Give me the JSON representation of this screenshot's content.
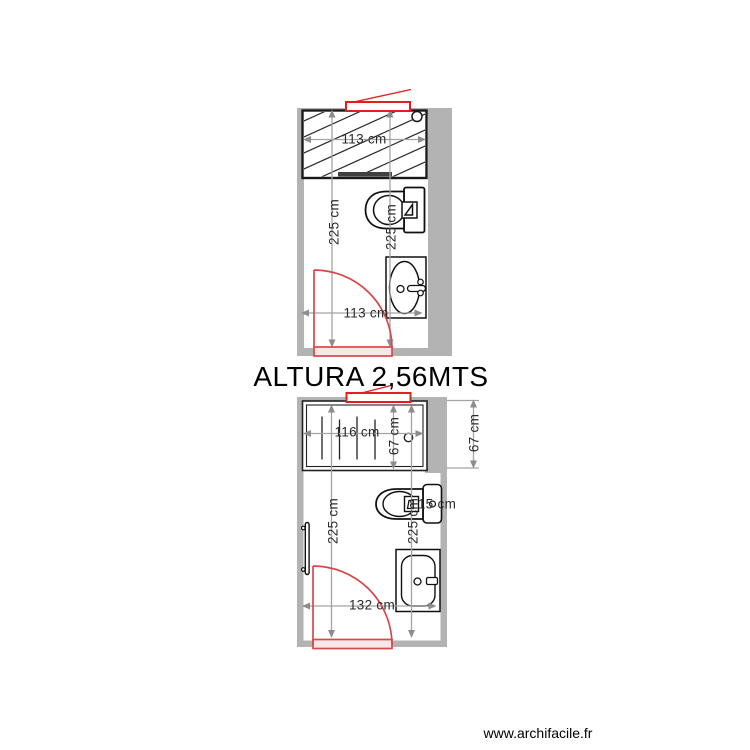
{
  "annotation": {
    "height_label": "ALTURA 2,56MTS"
  },
  "footer": {
    "website": "www.archifacile.fr"
  },
  "plan_top": {
    "dim_shower_width": "113 cm",
    "dim_depth_left": "225 cm",
    "dim_depth_right": "225 cm",
    "dim_door_width": "113 cm"
  },
  "plan_bottom": {
    "dim_shower_width": "116 cm",
    "dim_shower_depth": "67 cm",
    "dim_depth_left": "225 cm",
    "dim_depth_right": "225 cm",
    "dim_toilet_gap": "15 cm",
    "dim_door_width": "132 cm",
    "dim_exterior_wall": "67 cm"
  },
  "icons": {
    "shower": "shower-icon",
    "toilet": "toilet-icon",
    "sink": "sink-icon",
    "door": "door-swing-icon",
    "window": "window-icon",
    "radiator": "radiator-icon",
    "drain": "drain-icon"
  },
  "colors": {
    "wall": "#b3b3b3",
    "dimension_line": "#a3a3a3",
    "dimension_arrow": "#8d8d8d",
    "fixture_line": "#111111",
    "window_red": "#e41e1e",
    "door_red": "#d84848",
    "text": "#000000"
  }
}
